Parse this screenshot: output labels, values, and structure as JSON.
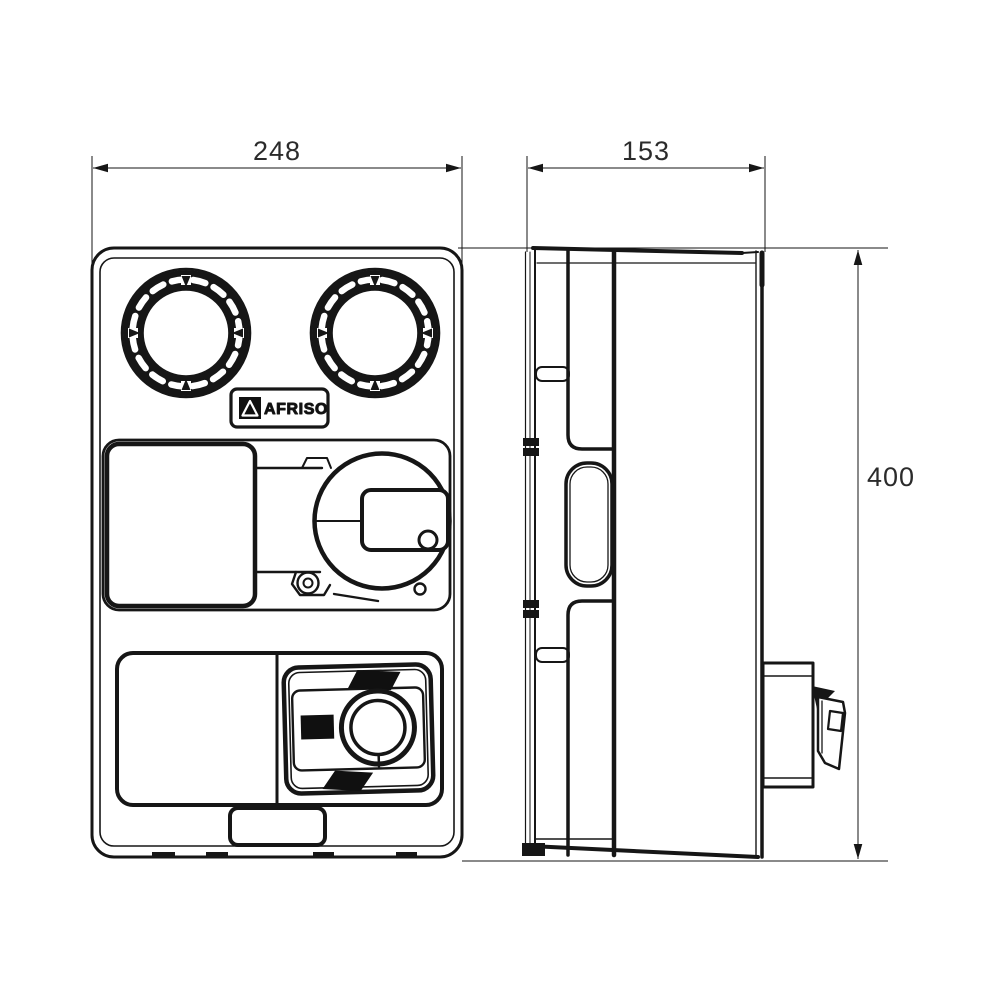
{
  "page": {
    "background": "#ffffff",
    "line_color": "#161616",
    "type": "technical-dimension-drawing"
  },
  "dimensions": {
    "front_width": "248",
    "side_depth": "153",
    "height": "400"
  },
  "logo": {
    "text": "AFRISO"
  }
}
